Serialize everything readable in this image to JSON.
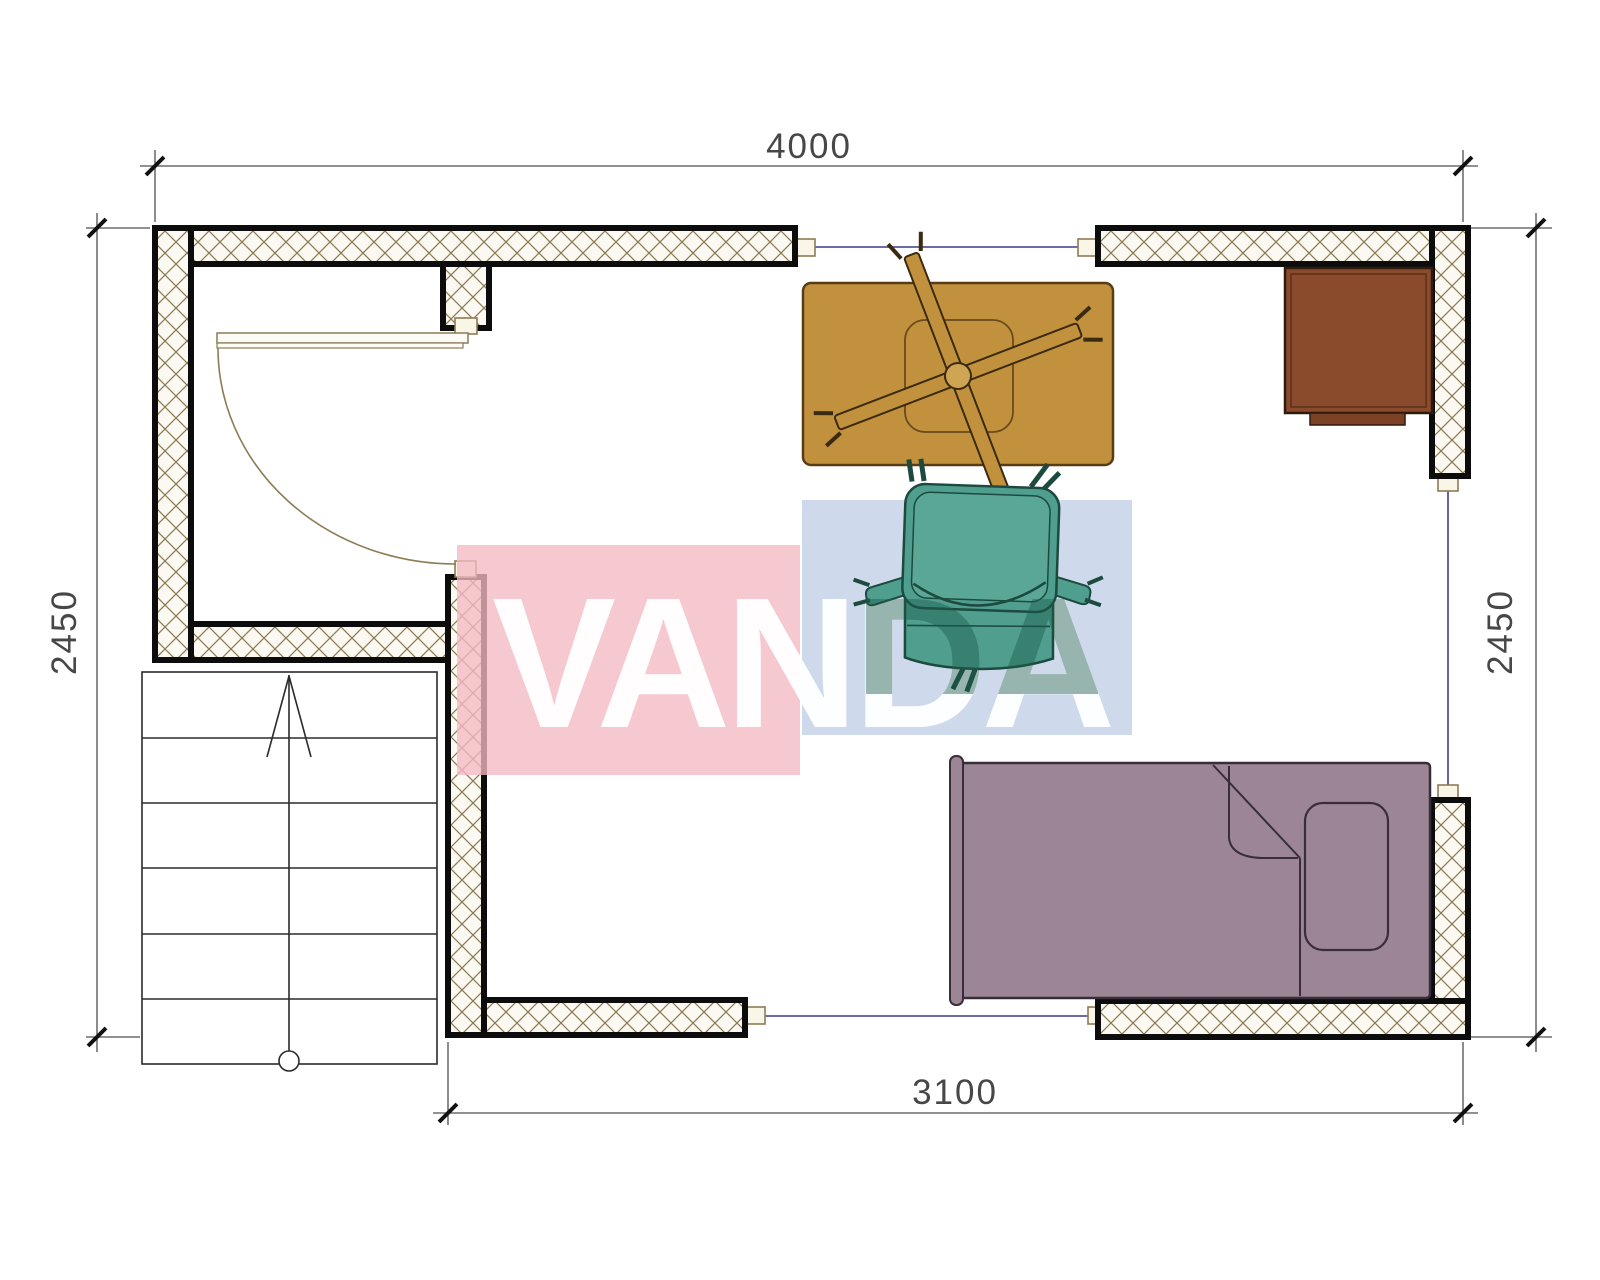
{
  "drawing": {
    "type": "floor-plan",
    "dimensions": {
      "top": "4000",
      "bottom": "3100",
      "left": "2450",
      "right": "2450"
    },
    "watermark": {
      "text": "VANDA"
    },
    "furniture": [
      {
        "name": "table-with-fan",
        "label": "table"
      },
      {
        "name": "desk-chair",
        "label": "chair"
      },
      {
        "name": "single-bed",
        "label": "bed"
      },
      {
        "name": "cabinet",
        "label": "cabinet"
      },
      {
        "name": "staircase",
        "label": "stairs"
      }
    ]
  },
  "colors": {
    "wall_hatch": "#8d7c55",
    "wall_outline": "#0c0c0c",
    "window_glass": "#3c3c8f",
    "dimension": "#474747",
    "table": "#c2913d",
    "table_trim": "#5a3c14",
    "cabinet": "#8a4a2c",
    "cabinet_tab": "#7d4226",
    "bed": "#9c8695",
    "bed_outline": "#382d39",
    "chair": "#4f9e8e",
    "chair_inner": "#5aa795",
    "chair_outline": "#1c4a3e",
    "watermark_pink": "#f4bac4",
    "watermark_blue": "#c5d4e9",
    "watermark_text": "#ffffff",
    "watermark_text_on_chair": "#1d5b4c"
  }
}
